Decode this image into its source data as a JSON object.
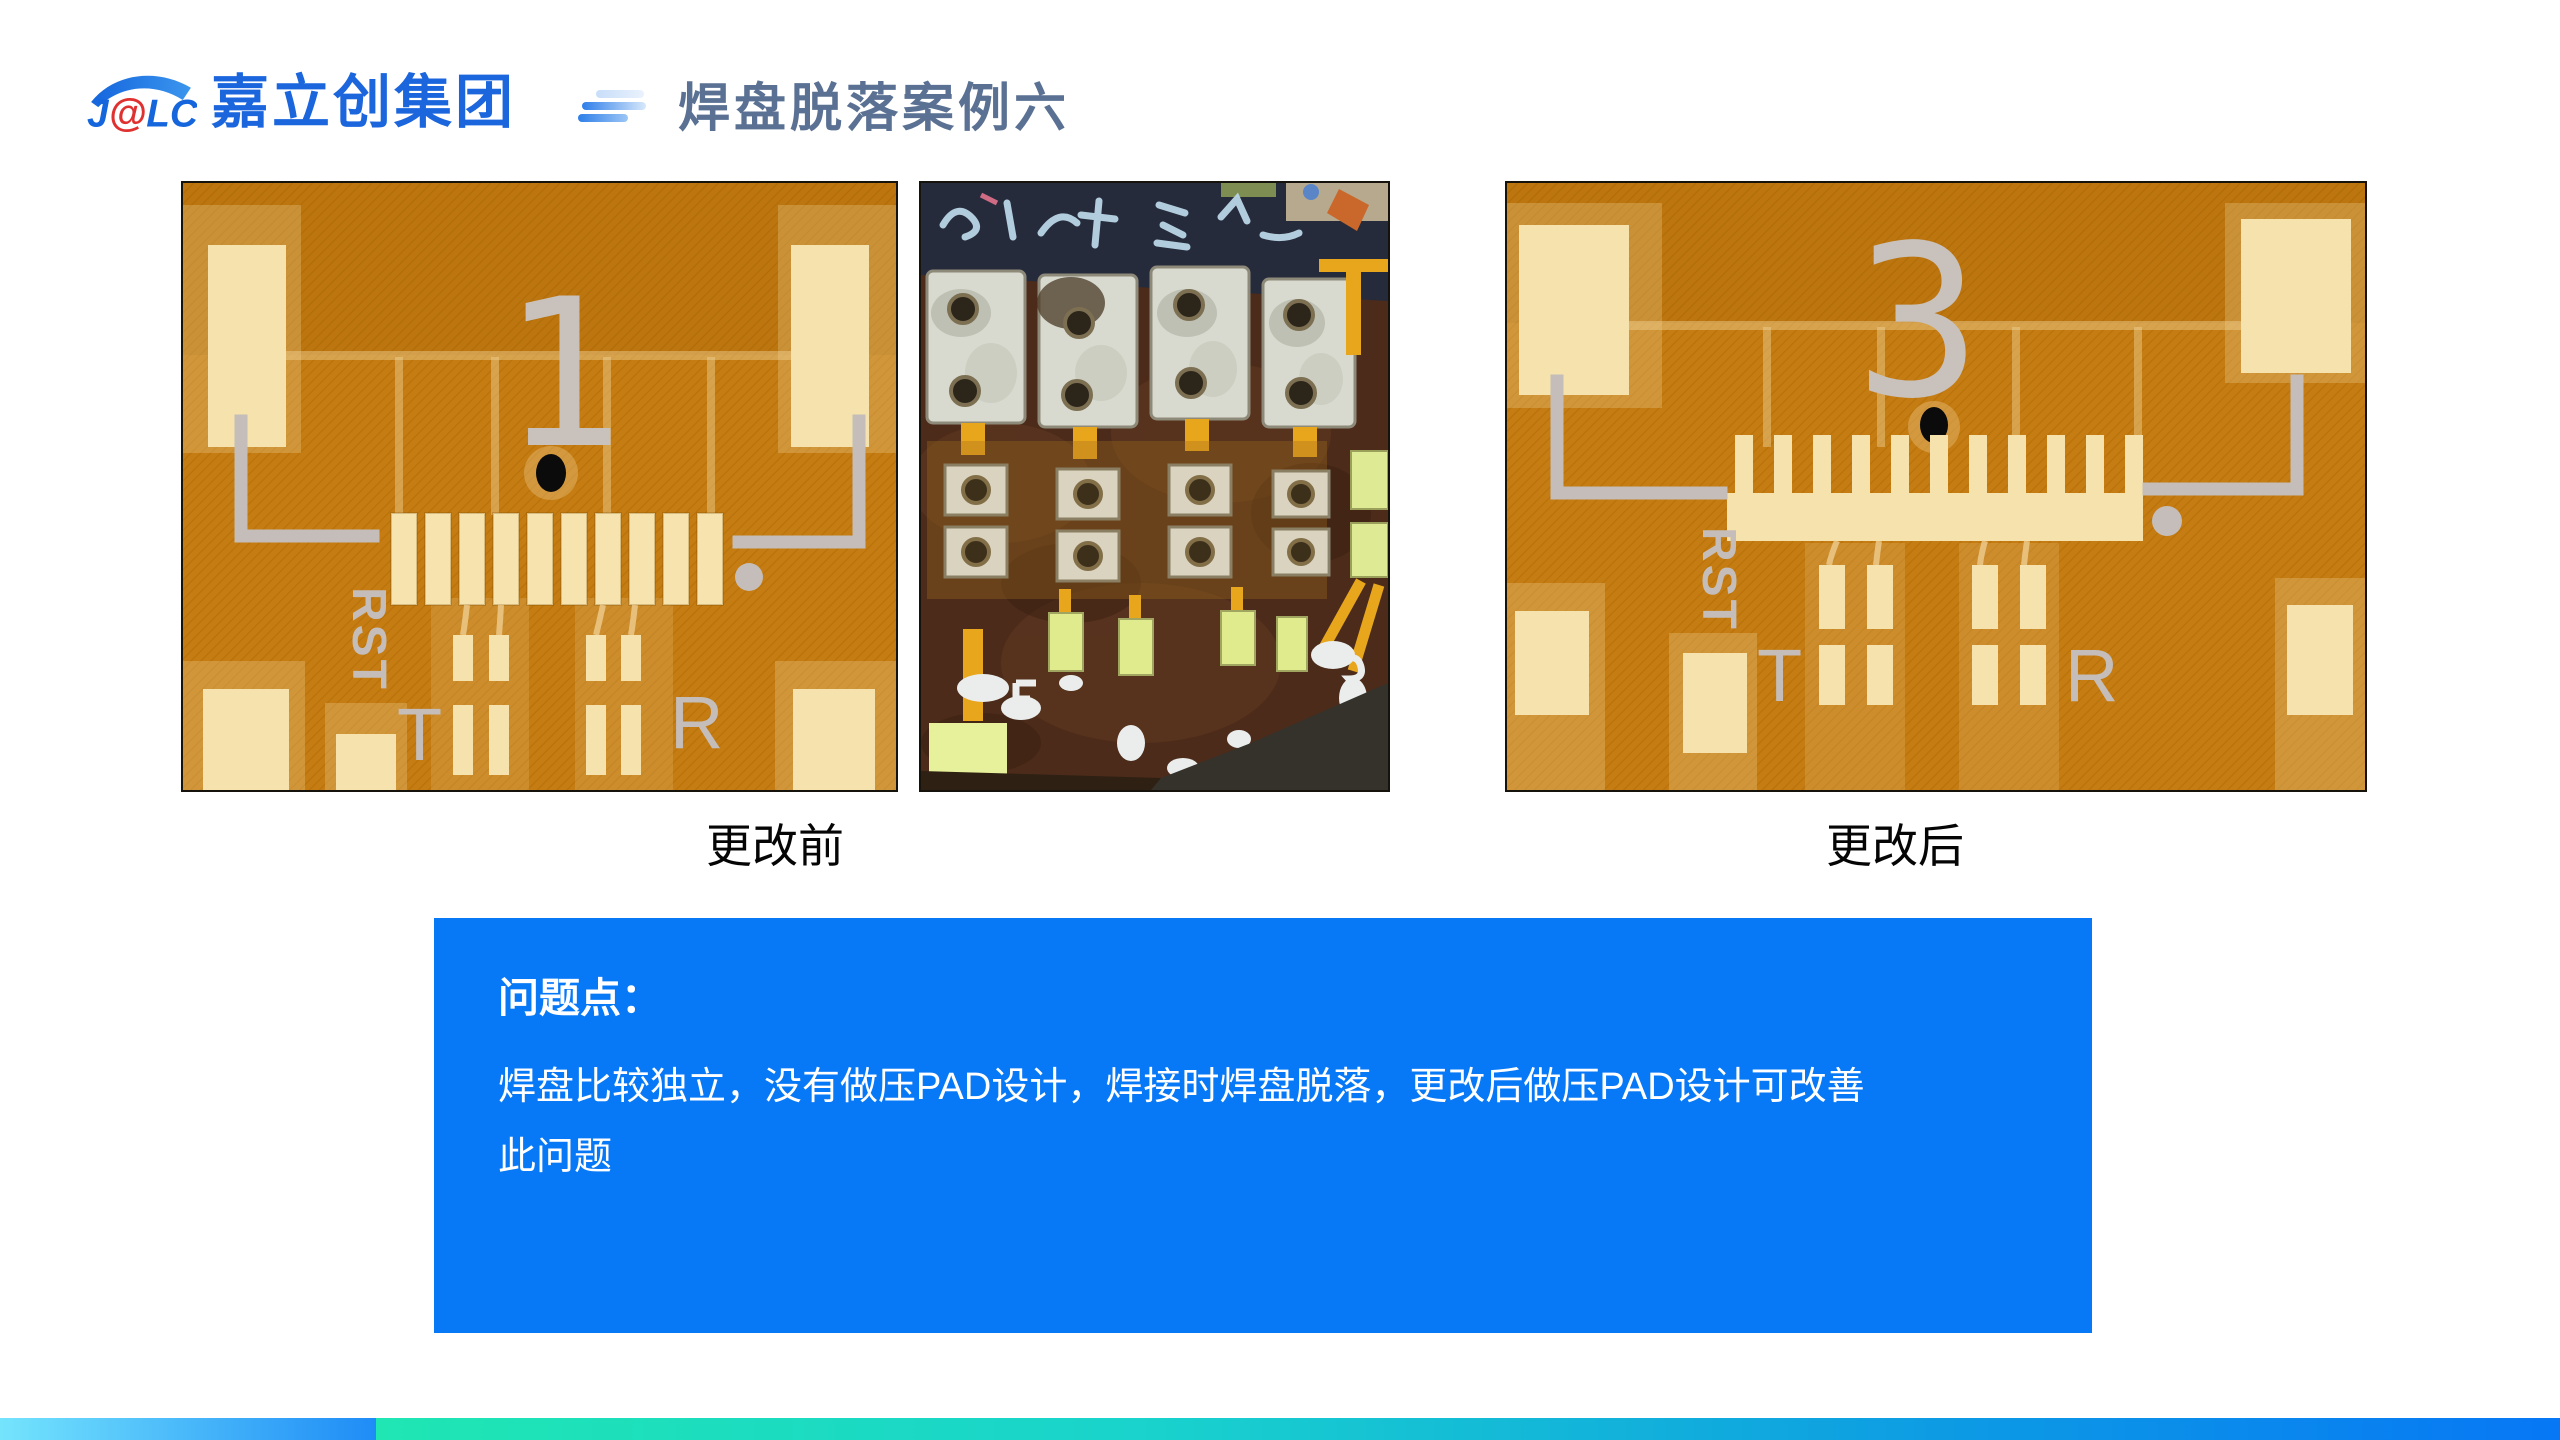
{
  "logo": {
    "j": "J",
    "at": "@",
    "lc": "LC",
    "company": "嘉立创集团"
  },
  "title": "焊盘脱落案例六",
  "boards": {
    "before": {
      "number": "1",
      "rst": "RST",
      "t": "T",
      "r": "R",
      "caption": "更改前"
    },
    "after": {
      "number": "3",
      "rst": "RST",
      "t": "T",
      "r": "R",
      "caption": "更改后"
    }
  },
  "info_box": {
    "heading": "问题点：",
    "body_line1": "焊盘比较独立，没有做压PAD设计，焊接时焊盘脱落，更改后做压PAD设计可改善",
    "body_line2": "此问题"
  },
  "colors": {
    "logo_blue": "#1B66DD",
    "logo_red": "#E03131",
    "title_slate": "#5A7193",
    "info_box_blue": "#0778F6",
    "board_copper": "#C57C12",
    "board_pad_cream": "#F5E2AC",
    "silkscreen_gray": "#C4BDB9",
    "footer_left_start": "#74E4FD",
    "footer_left_end": "#1E8CF6",
    "footer_teal": "#1FE6B3",
    "footer_blue": "#0777F5"
  }
}
